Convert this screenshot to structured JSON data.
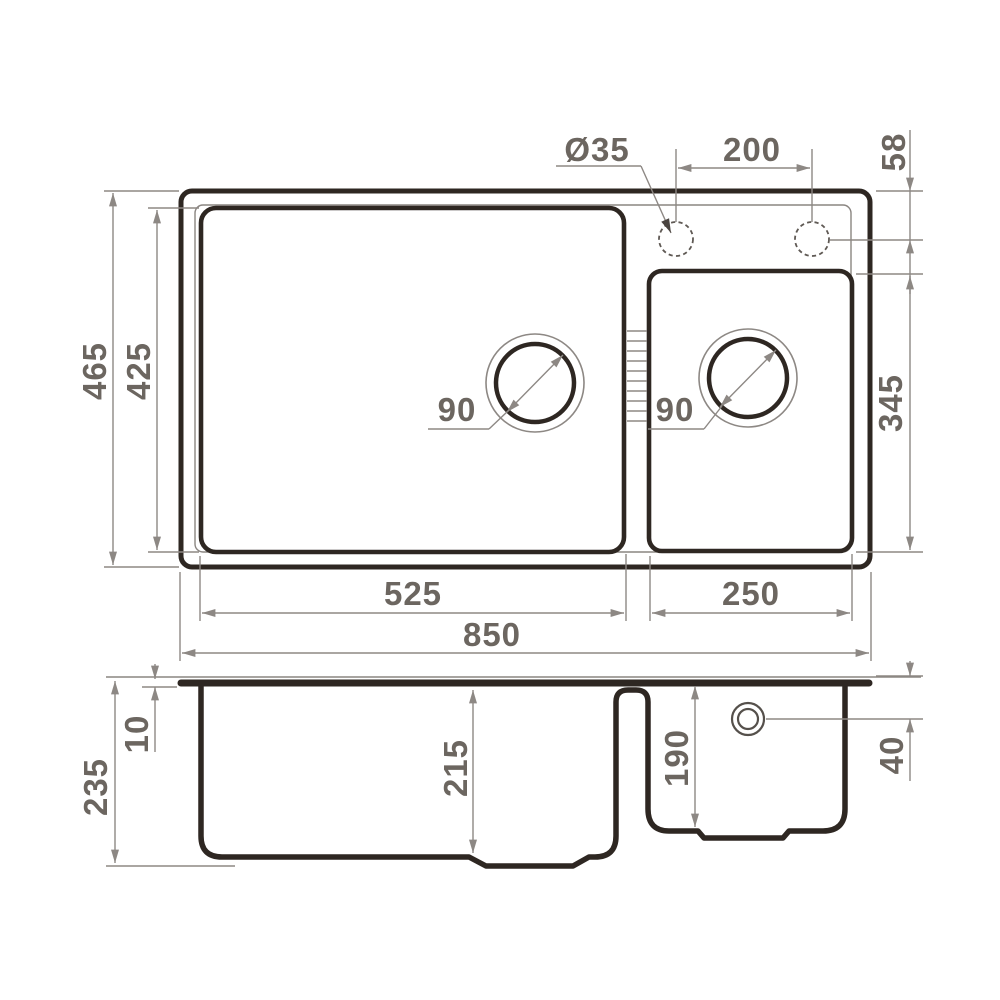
{
  "drawing": {
    "type": "kitchen sink technical dimension drawing, two views (plan and section)",
    "colors": {
      "background": "#ffffff",
      "outline": "#2e2722",
      "dimension_lines": "#8d8884",
      "labels": "#6c6660"
    },
    "top_view": {
      "overall_width": "850",
      "overall_depth": "465",
      "main_bowl_width": "525",
      "main_bowl_depth": "425",
      "second_bowl_width": "250",
      "second_bowl_depth": "345",
      "faucet_hole_diameter": "Ø35",
      "faucet_hole_spacing": "200",
      "faucet_hole_offset": "58",
      "main_drain_diameter": "90",
      "second_drain_diameter": "90"
    },
    "section_view": {
      "overall_height": "235",
      "rim_thickness": "10",
      "main_bowl_depth": "215",
      "second_bowl_depth": "190",
      "overflow_offset": "40"
    }
  }
}
